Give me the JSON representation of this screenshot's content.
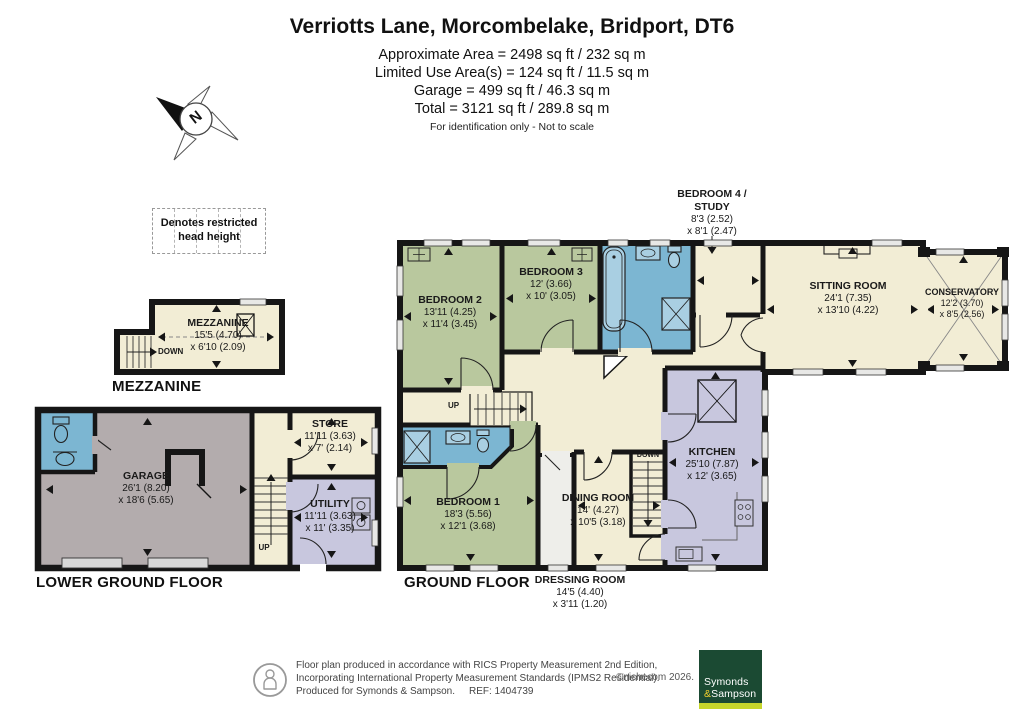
{
  "header": {
    "title": "Verriotts Lane, Morcombelake, Bridport, DT6",
    "area_lines": [
      "Approximate Area = 2498 sq ft / 232 sq m",
      "Limited Use Area(s) = 124 sq ft / 11.5 sq m",
      "Garage = 499 sq ft / 46.3 sq m",
      "Total = 3121 sq ft / 289.8 sq m"
    ],
    "note": "For identification only - Not to scale"
  },
  "north_label": "N",
  "legend_text": "Denotes restricted head height",
  "floor_labels": {
    "mezzanine": "MEZZANINE",
    "lower_ground": "LOWER GROUND FLOOR",
    "ground": "GROUND FLOOR"
  },
  "stair_labels": {
    "up": "UP",
    "down": "DOWN"
  },
  "rooms": {
    "mezzanine": {
      "name": "MEZZANINE",
      "dim1": "15'5 (4.70)",
      "dim2": "x 6'10 (2.09)"
    },
    "garage": {
      "name": "GARAGE",
      "dim1": "26'1 (8.20)",
      "dim2": "x 18'6 (5.65)"
    },
    "store": {
      "name": "STORE",
      "dim1": "11'11 (3.63)",
      "dim2": "x 7' (2.14)"
    },
    "utility": {
      "name": "UTILITY",
      "dim1": "11'11 (3.63)",
      "dim2": "x 11' (3.35)"
    },
    "bedroom1": {
      "name": "BEDROOM 1",
      "dim1": "18'3 (5.56)",
      "dim2": "x 12'1 (3.68)"
    },
    "bedroom2": {
      "name": "BEDROOM 2",
      "dim1": "13'11 (4.25)",
      "dim2": "x 11'4 (3.45)"
    },
    "bedroom3": {
      "name": "BEDROOM 3",
      "dim1": "12' (3.66)",
      "dim2": "x 10' (3.05)"
    },
    "bedroom4": {
      "name": "BEDROOM 4 /",
      "name2": "STUDY",
      "dim1": "8'3 (2.52)",
      "dim2": "x 8'1 (2.47)"
    },
    "sitting_room": {
      "name": "SITTING ROOM",
      "dim1": "24'1 (7.35)",
      "dim2": "x 13'10 (4.22)"
    },
    "conservatory": {
      "name": "CONSERVATORY",
      "dim1": "12'2 (3.70)",
      "dim2": "x 8'5 (2.56)"
    },
    "kitchen": {
      "name": "KITCHEN",
      "dim1": "25'10 (7.87)",
      "dim2": "x 12' (3.65)"
    },
    "dining_room": {
      "name": "DINING ROOM",
      "dim1": "14' (4.27)",
      "dim2": "x 10'5 (3.18)"
    },
    "dressing_room": {
      "name": "DRESSING ROOM",
      "dim1": "14'5 (4.40)",
      "dim2": "x 3'11 (1.20)"
    }
  },
  "footer": {
    "line1": "Floor plan produced in accordance with RICS Property Measurement 2nd Edition,",
    "line2": "Incorporating International Property Measurement Standards (IPMS2 Residential).",
    "line3": "Produced for Symonds & Sampson.",
    "ref": "REF: 1404739",
    "copyright": "©nichecom 2026.",
    "logo_line1": "Symonds",
    "logo_amp": "&",
    "logo_line2": "Sampson"
  },
  "colors": {
    "wall": "#161616",
    "room_cream": "#f2edd5",
    "bedroom_green": "#b9c89e",
    "bath_blue": "#7cb6d2",
    "kitchen_lavender": "#c8c7de",
    "garage_grey": "#b3acad",
    "dressing_white": "#eeeeea",
    "logo_green": "#1b4a33",
    "logo_bar": "#c6d62c",
    "logo_amp_yellow": "#f0ce2e"
  }
}
